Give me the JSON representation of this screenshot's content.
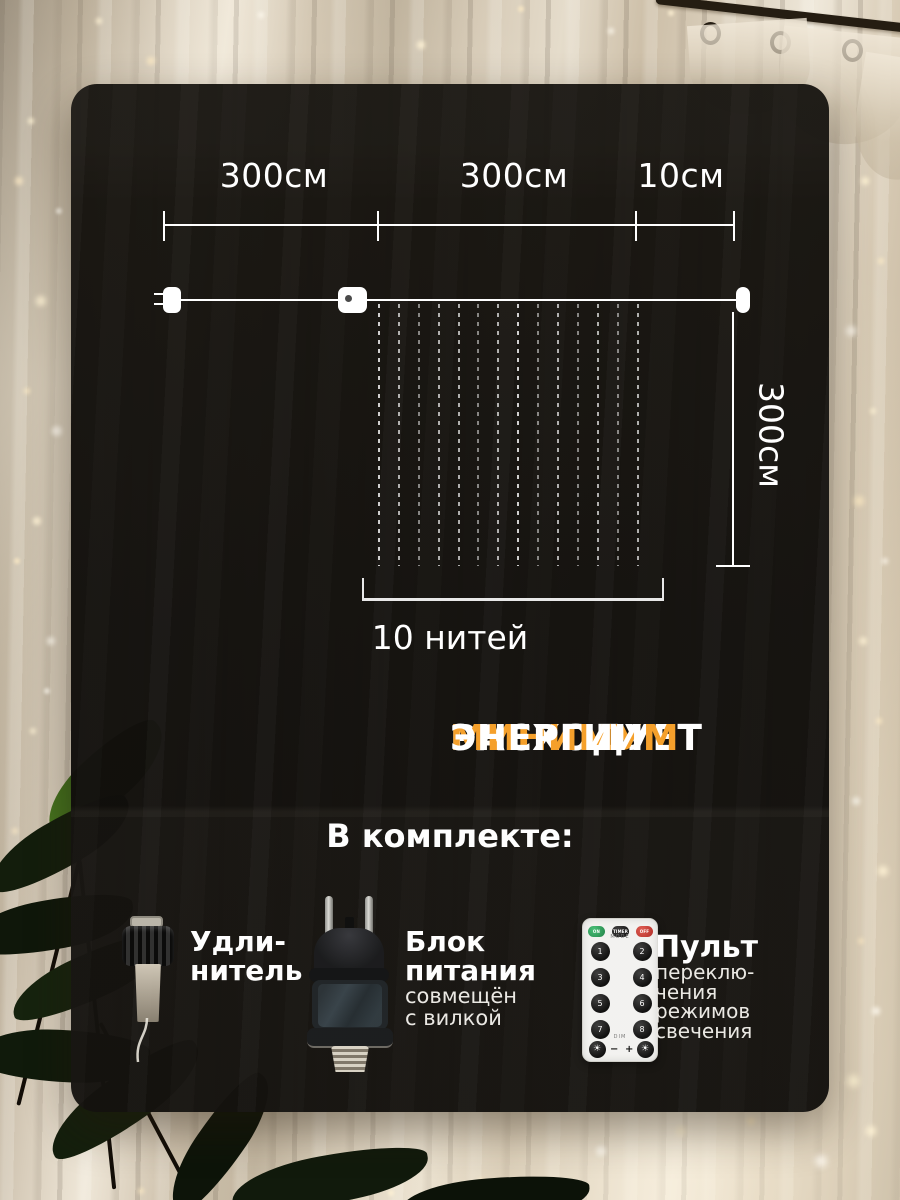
{
  "diagram": {
    "ruler_labels": [
      "300см",
      "300см",
      "10см"
    ],
    "height_label": "300см",
    "strands_caption": "10 нитей"
  },
  "headline": {
    "pre": "РАСХОДУЕТ ",
    "highlight": "МИНИМУМ",
    "post": " ЭНЕРГИИ",
    "highlight_color": "#F5A02B"
  },
  "kit_heading": "В комплекте:",
  "items": [
    {
      "title_lines": [
        "Удли-",
        "нитель"
      ],
      "sub_lines": []
    },
    {
      "title_lines": [
        "Блок",
        "питания"
      ],
      "sub_lines": [
        "совмещён",
        "с вилкой"
      ]
    },
    {
      "title_lines": [
        "Пульт"
      ],
      "sub_lines": [
        "переклю-",
        "чения",
        "режимов",
        "свечения"
      ]
    }
  ],
  "remote_labels": {
    "on": "ON",
    "timer": "TIMER",
    "off": "OFF",
    "mode": "MODE",
    "digits": [
      "1",
      "2",
      "3",
      "4",
      "5",
      "6",
      "7",
      "8"
    ],
    "dim": "DIM",
    "minus": "−",
    "plus": "+",
    "sun": "☀"
  }
}
